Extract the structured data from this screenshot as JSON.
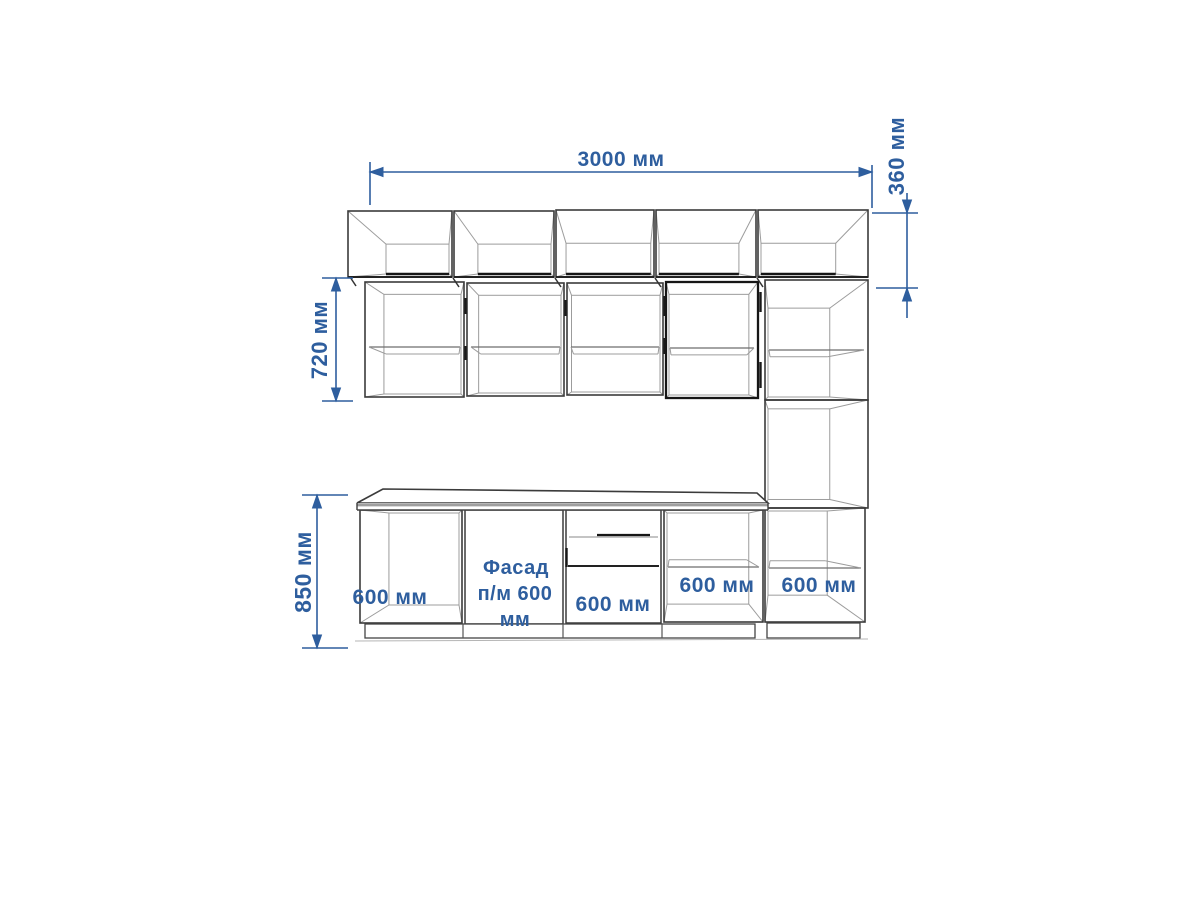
{
  "drawing": {
    "kind": "kitchen cabinet elevation drawing",
    "units": "мм",
    "colors": {
      "dimension_blue": "#2e5e9e",
      "outline": "#3b3b3b",
      "outline_dark": "#161616",
      "interior_gray": "#9c9c9c",
      "shelf_gray": "#6e6e6e",
      "countertop_band": "#9e9e9e",
      "floor_gray": "#b5b5b5",
      "background": "#ffffff"
    },
    "dimensions": {
      "total_width": {
        "label": "3000 мм",
        "value_mm": 3000,
        "orientation": "horizontal"
      },
      "upper_row_height": {
        "label": "360 мм",
        "value_mm": 360,
        "orientation": "vertical"
      },
      "wall_cabinet_height": {
        "label": "720 мм",
        "value_mm": 720,
        "orientation": "vertical"
      },
      "base_height": {
        "label": "850 мм",
        "value_mm": 850,
        "orientation": "vertical"
      }
    },
    "cabinet_labels": {
      "base_1": {
        "label": "600 мм"
      },
      "base_2": {
        "label": "Фасад п/м 600 мм",
        "lines": [
          "Фасад",
          "п/м 600",
          "мм"
        ]
      },
      "base_3": {
        "label": "600 мм"
      },
      "base_4": {
        "label": "600 мм"
      },
      "tall_base": {
        "label": "600 мм"
      }
    }
  }
}
